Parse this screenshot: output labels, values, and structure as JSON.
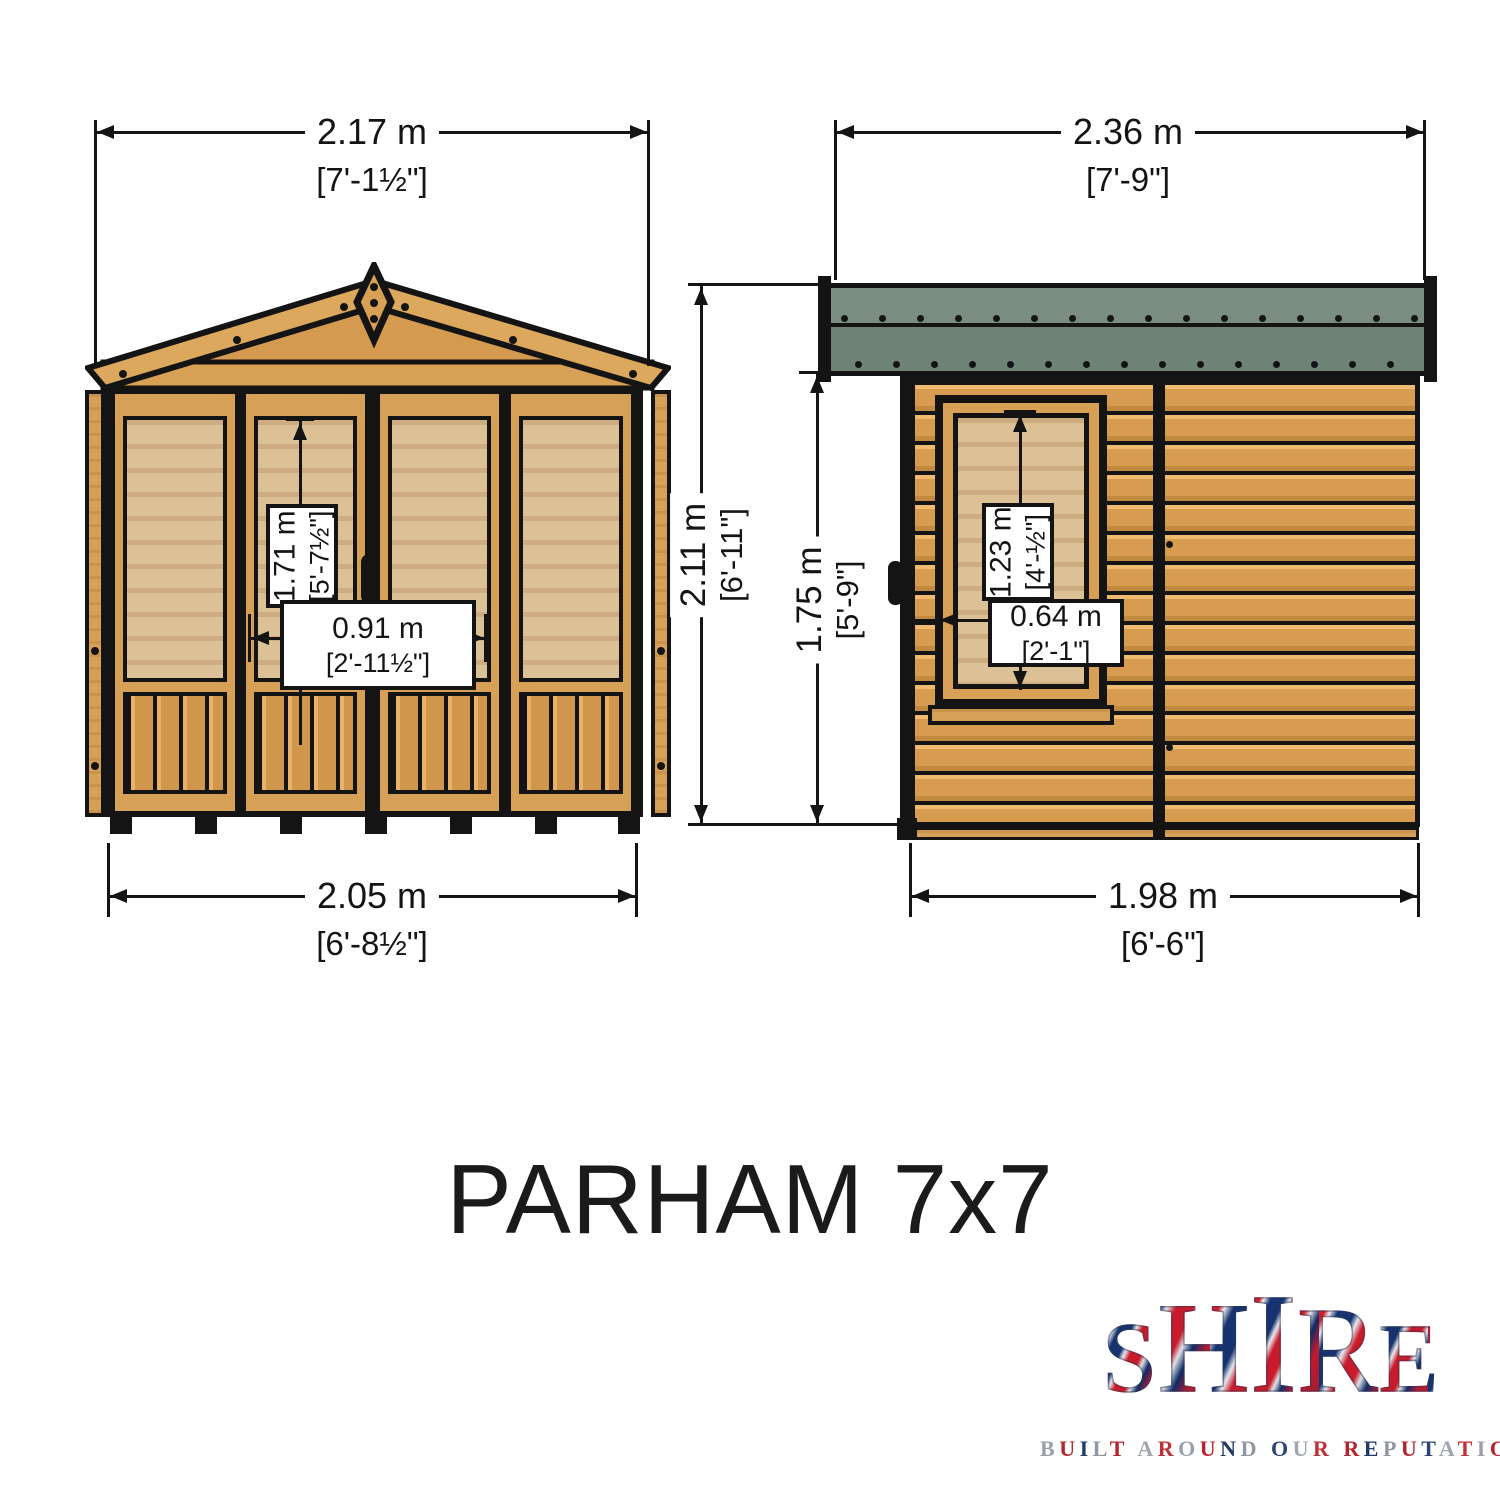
{
  "title": "PARHAM 7x7",
  "front_view": {
    "width_overall": {
      "metric": "2.17 m",
      "imperial": "[7'-1½\"]"
    },
    "width_base": {
      "metric": "2.05 m",
      "imperial": "[6'-8½\"]"
    },
    "door_height": {
      "metric": "1.71 m",
      "imperial": "[5'-7½\"]"
    },
    "door_width": {
      "metric": "0.91 m",
      "imperial": "[2'-11½\"]"
    }
  },
  "side_view": {
    "width_overall": {
      "metric": "2.36 m",
      "imperial": "[7'-9\"]"
    },
    "width_base": {
      "metric": "1.98 m",
      "imperial": "[6'-6\"]"
    },
    "height_ridge": {
      "metric": "2.11 m",
      "imperial": "[6'-11\"]"
    },
    "height_eaves": {
      "metric": "1.75 m",
      "imperial": "[5'-9\"]"
    },
    "window_height": {
      "metric": "1.23 m",
      "imperial": "[4'-½\"]"
    },
    "window_width": {
      "metric": "0.64 m",
      "imperial": "[2'-1\"]"
    }
  },
  "logo": {
    "brand": "SHIRE",
    "tagline": "BUILT AROUND OUR REPUTATION",
    "tagline_colors": [
      "#9aa0aa",
      "#b5242c",
      "#22396b",
      "#8f97a1",
      "#b5242c",
      "#2a4378",
      "#a0a6af",
      "#c03038"
    ]
  },
  "colors": {
    "wood": "#d7a057",
    "glazing": "#dcc096",
    "roof_felt": "#6f8276",
    "roof_felt_light": "#7b8d80",
    "outline": "#141414"
  }
}
